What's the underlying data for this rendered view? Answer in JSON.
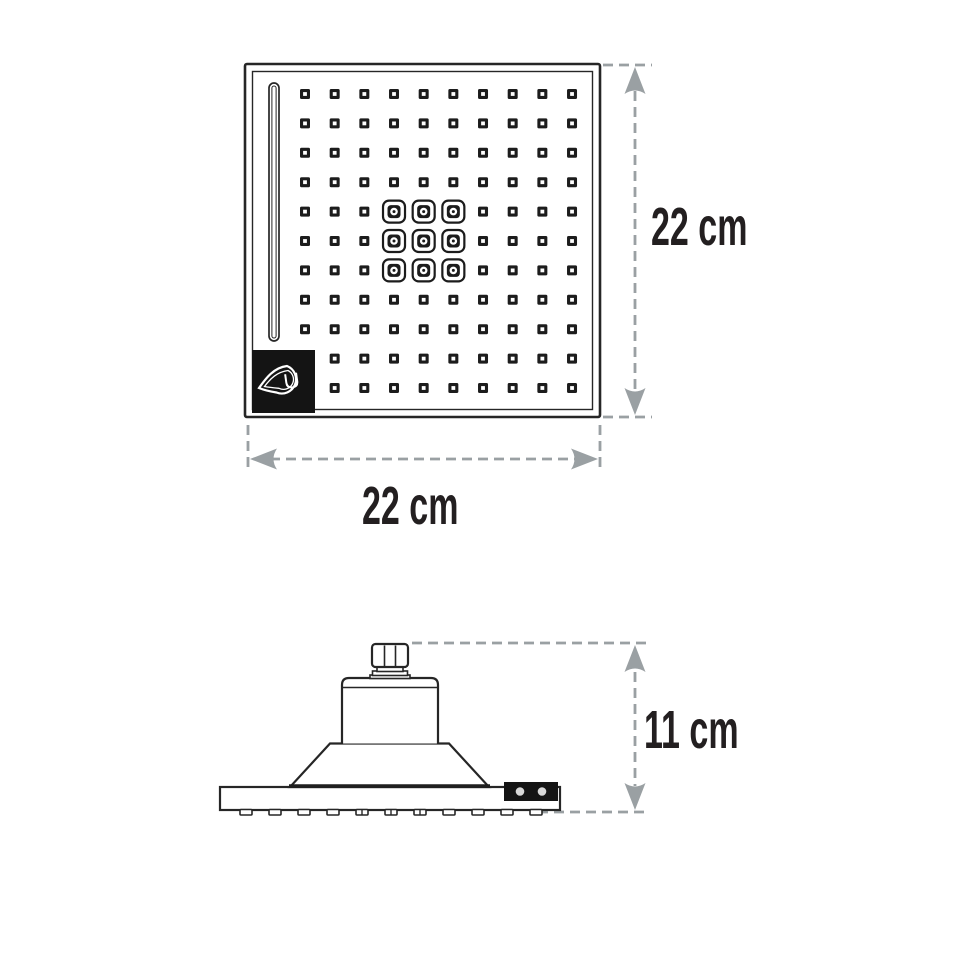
{
  "labels": {
    "front_height": "22 cm",
    "front_width": "22 cm",
    "side_height": "11 cm"
  },
  "front_view": {
    "shape": "square shower face, double-line border",
    "water_slot": "vertical slot along left edge",
    "nozzle_grid": {
      "columns": 10,
      "rows": 11,
      "large_jet_rows_1based": [
        5,
        6,
        7
      ],
      "large_jet_cols_1based": [
        4,
        5,
        6
      ],
      "bottom_rows_missing_first_column": 2
    },
    "logo": "drop-logo on black corner plate"
  },
  "side_view": {
    "parts": [
      "connector-nut",
      "collar",
      "neck-cylinder",
      "cone",
      "face-plate",
      "brand-tab",
      "nozzle-bumps"
    ],
    "bump_count": 11,
    "tab_dot_count": 2
  },
  "colors": {
    "line": "#262626",
    "nozzle": "#1c1c1c",
    "dimension": "#9aa0a3",
    "label": "#231f20",
    "logo_bg": "#141414",
    "tab_dot": "#d8d8d8",
    "background": "#ffffff"
  }
}
